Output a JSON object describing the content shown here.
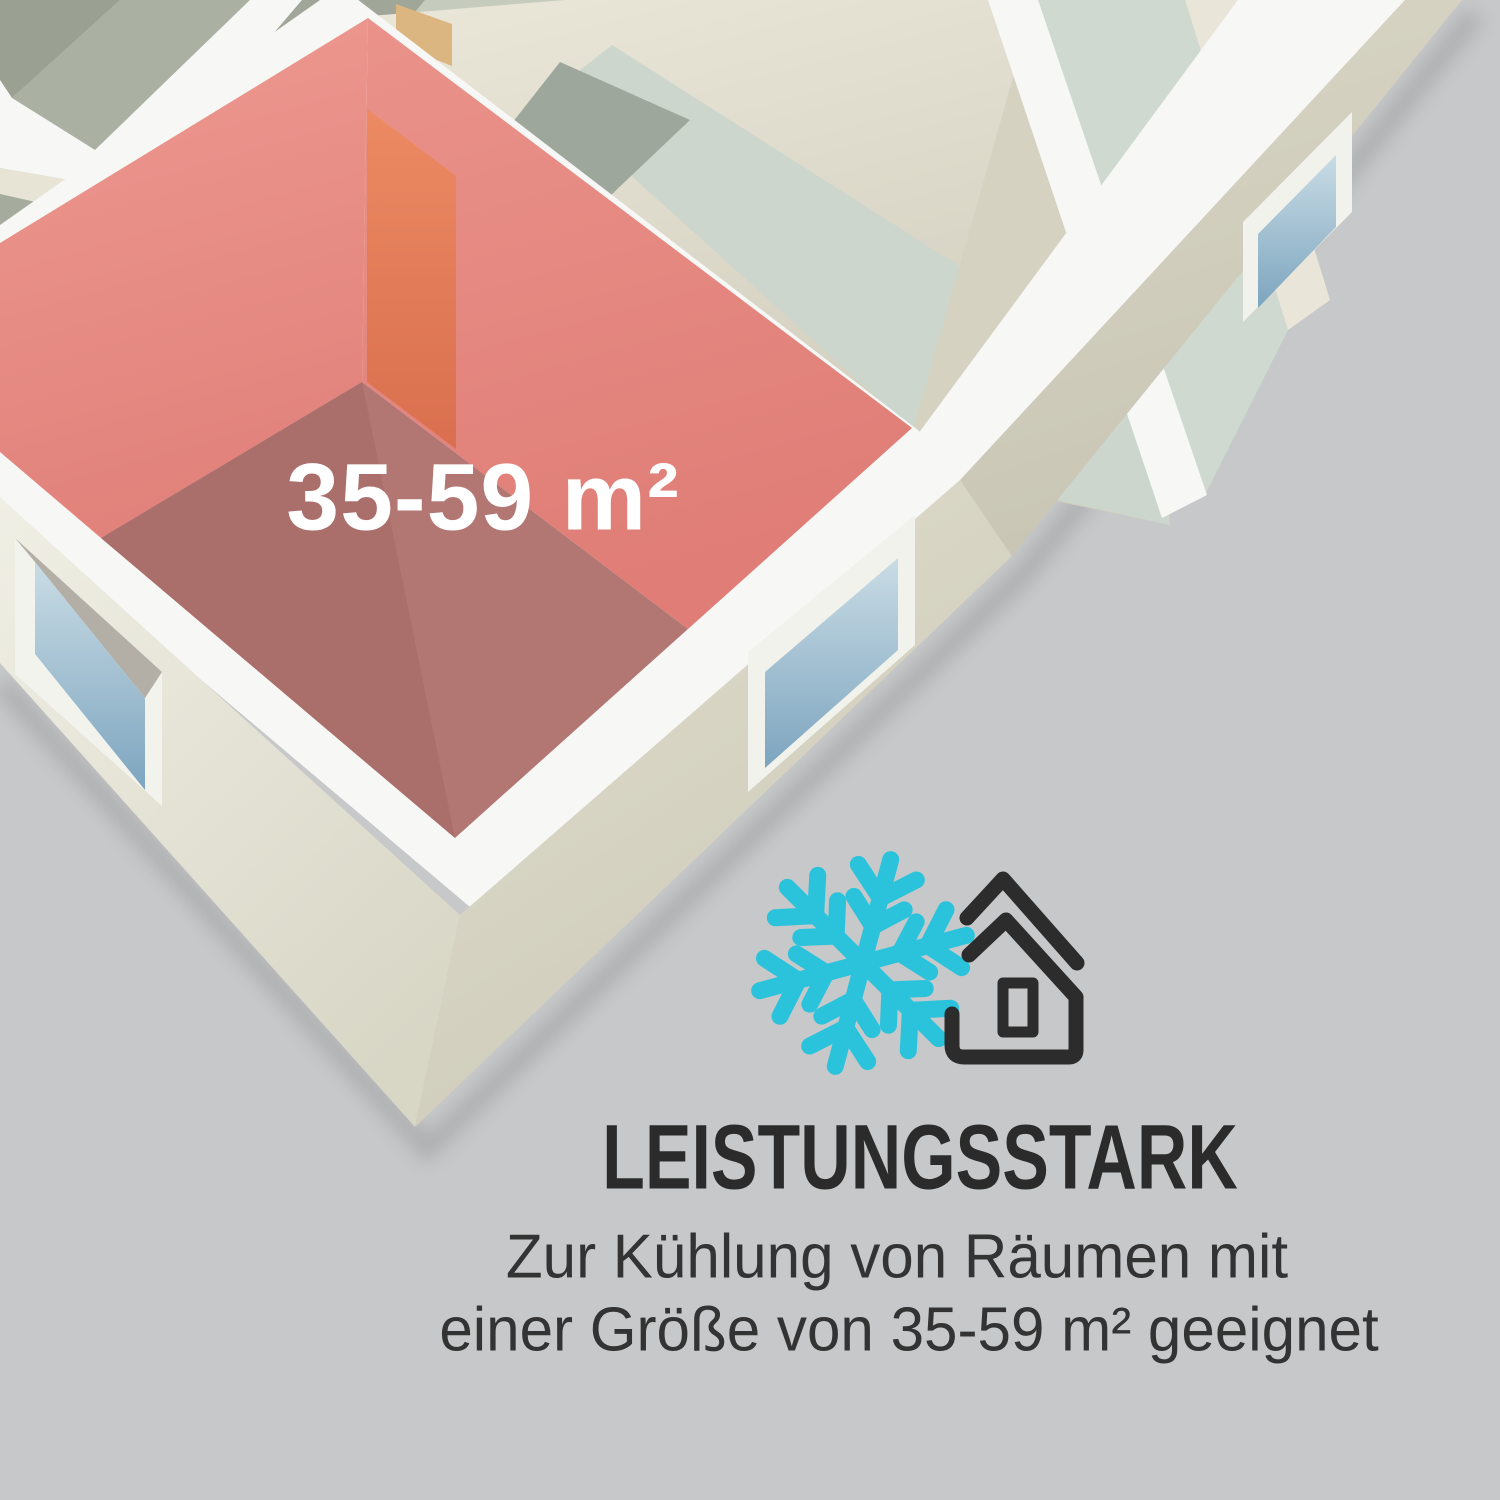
{
  "page": {
    "background_color": "#c7c8c9"
  },
  "floorplan": {
    "room_label": "35-59 m²",
    "highlight_wall_color": "#e8918a",
    "highlight_floor_color": "#b17672",
    "door_color": "#e27e58",
    "back_door_color": "#dcb680",
    "wall_rim_color": "#f7f8f6",
    "teal_floor_color": "#ccd6cd",
    "dark_floor_color": "#9da79b",
    "back_wall_dark": "#9aa092",
    "back_wall_mid": "#abb1a2",
    "back_wall_light": "#c6ccbd",
    "window_glass_top": "#c9dce5",
    "window_glass_bottom": "#7da5bf",
    "window_frame_color": "#f3f3ee"
  },
  "info": {
    "heading": "LEISTUNGSSTARK",
    "subtitle_line1": "Zur Kühlung von Räumen mit",
    "subtitle_line2": "einer Größe von 35-59 m² geeignet",
    "text_color": "#2b2b2b"
  },
  "icons": {
    "snowflake": {
      "name": "snowflake-icon",
      "color": "#2bc3dc"
    },
    "house": {
      "name": "house-icon",
      "color": "#2c2c2c"
    }
  }
}
